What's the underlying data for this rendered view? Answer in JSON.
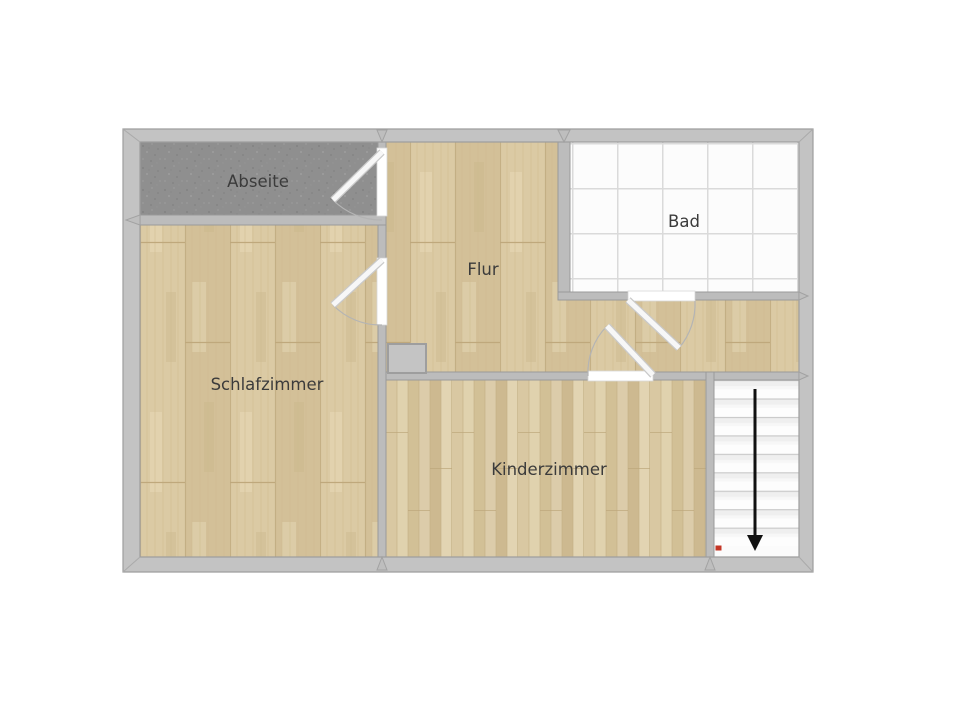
{
  "floorplan": {
    "type": "apartment-upper-floor-plan",
    "rooms": [
      {
        "id": "abseite",
        "label": "Abseite",
        "floor_type": "gray-storage"
      },
      {
        "id": "flur",
        "label": "Flur",
        "floor_type": "wood-plank"
      },
      {
        "id": "bad",
        "label": "Bad",
        "floor_type": "white-tile"
      },
      {
        "id": "schlafzimmer",
        "label": "Schlafzimmer",
        "floor_type": "wood-plank"
      },
      {
        "id": "kinderzimmer",
        "label": "Kinderzimmer",
        "floor_type": "wood-fine-plank"
      },
      {
        "id": "treppe",
        "label": "",
        "floor_type": "staircase"
      }
    ],
    "doors": [
      {
        "id": "door-abseite",
        "between": [
          "flur",
          "abseite"
        ]
      },
      {
        "id": "door-schlafzimmer",
        "between": [
          "flur",
          "schlafzimmer"
        ]
      },
      {
        "id": "door-bad",
        "between": [
          "flur",
          "bad"
        ]
      },
      {
        "id": "door-kinderzimmer",
        "between": [
          "flur",
          "kinderzimmer"
        ]
      }
    ],
    "stairs": {
      "steps": 9,
      "direction": "down",
      "arrow": "down-arrow",
      "marker": "red-entry-dot"
    },
    "chimney": {
      "present": true
    },
    "colors": {
      "background": "#ffffff",
      "outer_wall": "#c3c3c3",
      "inner_wall": "#bcbcbc",
      "wall_edge": "#9a9a9a",
      "abseite_floor": "#8f8f8f",
      "wood_base": "#d8c7a0",
      "wood_fine_base": "#d9c8a2",
      "tile": "#fcfcfc",
      "tile_line": "#dadada",
      "chimney_fill": "#c4c4c4",
      "door_leaf": "#f7f7f7",
      "swing_arc": "#b4b4b4",
      "label_text": "#3b3b3b",
      "stair_arrow": "#111111",
      "marker_red": "#c43626"
    }
  }
}
